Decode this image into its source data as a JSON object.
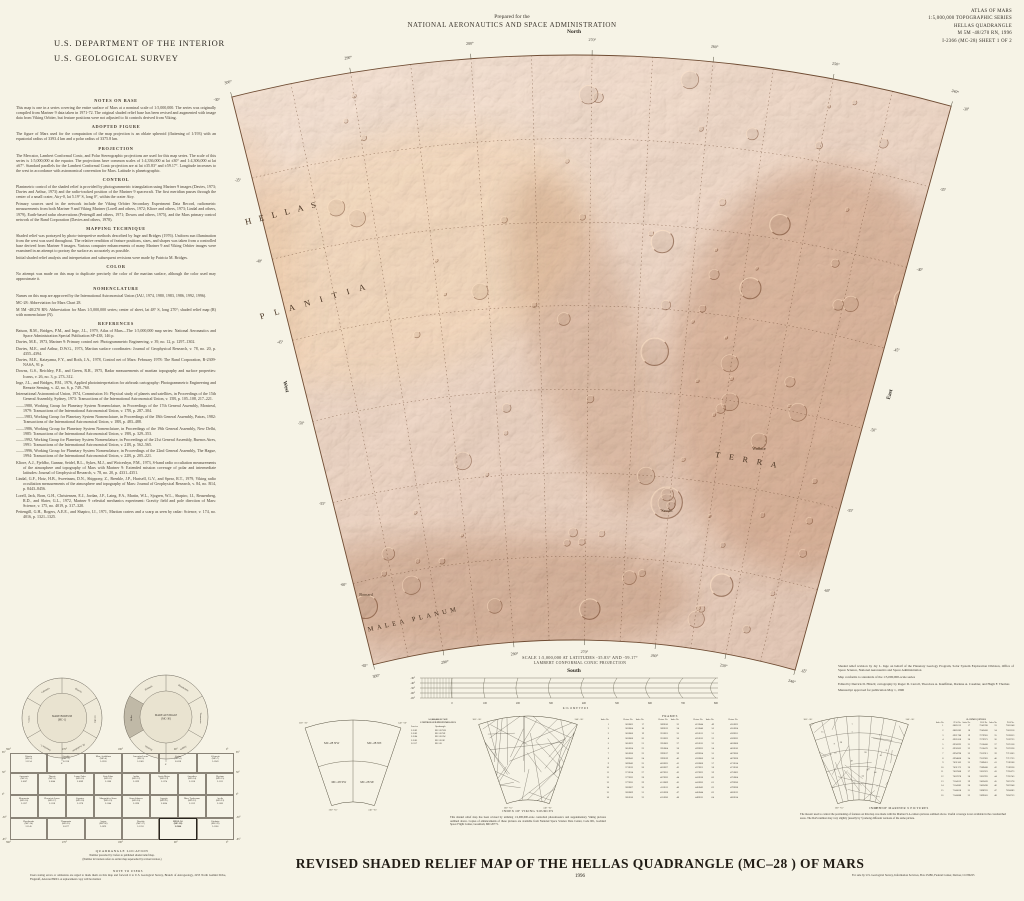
{
  "header": {
    "dept_line1": "U.S. DEPARTMENT OF THE INTERIOR",
    "dept_line2": "U.S. GEOLOGICAL SURVEY",
    "prepared_for": "Prepared for the",
    "nasa": "NATIONAL AERONAUTICS AND SPACE ADMINISTRATION",
    "atlas_lines": [
      "ATLAS OF MARS",
      "1:5,000,000 TOPOGRAPHIC SERIES",
      "HELLAS QUADRANGLE",
      "M 5M -48/270 RN, 1996",
      "I-2366 (MC-28) SHEET 1 OF 2"
    ]
  },
  "notes": {
    "sections": [
      {
        "heading": "NOTES ON BASE",
        "paragraphs": [
          "This map is one in a series covering the entire surface of Mars at a nominal scale of 1:5,000,000.  The series was originally compiled from Mariner 9 data taken in 1971-72.  The original shaded relief base has been revised and augmented with image data from Viking Orbiter, but feature positions were not adjusted to fit controls derived from Viking."
        ]
      },
      {
        "heading": "ADOPTED FIGURE",
        "paragraphs": [
          "The figure of Mars used for the computation of the map projection is an oblate spheroid (flattening of 1/193) with an equatorial radius of 3393.4 km and a polar radius of 3375.8 km."
        ]
      },
      {
        "heading": "PROJECTION",
        "paragraphs": [
          "The Mercator, Lambert Conformal Conic, and Polar Stereographic projections are used for this map series.  The scale of this series is 1:5,000,000 at the equator.  The projections have common scales of 1:4,336,000 at lat ±30° and 1:4,306,000 at lat ±67°.  Standard parallels for the Lambert Conformal Conic projection are at lat ±35.83° and ±59.17°.  Longitude increases to the west in accordance with astronomical convention for Mars.  Latitude is planetographic."
        ]
      },
      {
        "heading": "CONTROL",
        "paragraphs": [
          "Planimetric control of the shaded relief is provided by photogrammetric triangulation using Mariner 9 images (Davies, 1973; Davies and Arthur, 1973) and the radio-tracked position of the Mariner 9 spacecraft.  The first meridian passes through the center of a small crater, Airy-0, lat 5.19° S, long 0°, within the crater Airy.",
          "Primary sources used in the network include the Viking Orbiter Secondary Experiment Data Record, radiometric measurements from both Mariner 9 and Viking Mariner (Lorell and others, 1972; Kliore and others, 1973; Lindal and others, 1979), Earth-based radar observations (Pettengill and others, 1971; Downs and others, 1975), and the Mars primary control network of the Rand Corporation (Davies and others, 1978)."
        ]
      },
      {
        "heading": "MAPPING TECHNIQUE",
        "paragraphs": [
          "Shaded relief was portrayed by photo-interpretive methods described by Inge and Bridges (1976).  Uniform sun illumination from the west was used throughout.  The relative rendition of feature positions, sizes, and shapes was taken from a controlled base derived from Mariner 9 images.  Various computer enhancements of many Mariner 9 and Viking Orbiter images were examined in an attempt to portray the surface as accurately as possible.",
          "Initial shaded relief analysis and interpretation and subsequent revisions were made by Patricia M. Bridges."
        ]
      },
      {
        "heading": "COLOR",
        "paragraphs": [
          "No attempt was made on this map to duplicate precisely the color of the martian surface, although the color used may approximate it."
        ]
      },
      {
        "heading": "NOMENCLATURE",
        "paragraphs": [
          "Names on this map are approved by the International Astronomical Union (IAU, 1974, 1980, 1983, 1986, 1992, 1996).",
          "MC-28:  Abbreviation for Mars Chart 28.",
          "M 5M -48/270 RN:  Abbreviation for Mars 1:5,000,000 series; center of sheet, lat 48° S, long 270°; shaded relief map (R) with nomenclature (N)."
        ]
      }
    ],
    "references_heading": "REFERENCES",
    "references": [
      "Batson, R.M., Bridges, P.M., and Inge, J.L., 1979, Atlas of Mars—The 1:5,000,000 map series: National Aeronautics and Space Administration Special Publication SP-438, 146 p.",
      "Davies, M.E., 1973, Mariner 9: Primary control net: Photogrammetric Engineering, v. 39, no. 12, p. 1297–1302.",
      "Davies, M.E., and Arthur, D.W.G., 1973, Martian surface coordinates: Journal of Geophysical Research, v. 78, no. 20, p. 4355–4394.",
      "Davies, M.E., Katayama, F.Y., and Roth, J.A., 1978, Control net of Mars: February 1978: The Rand Corporation, R-2309-NASA, 91 p.",
      "Downs, G.S., Reichley, P.E., and Green, R.R., 1975, Radar measurements of martian topography and surface properties: Icarus, v. 26, no. 3, p. 273–312.",
      "Inge, J.L., and Bridges, P.M., 1976, Applied photointerpretation for airbrush cartography: Photogrammetric Engineering and Remote Sensing, v. 42, no. 6, p. 749–760.",
      "International Astronomical Union, 1974, Commission 16: Physical study of planets and satellites, in Proceedings of the 15th General Assembly, Sydney, 1973: Transactions of the International Astronomical Union, v. 15B, p. 105–108, 217–221.",
      "——1980, Working Group for Planetary System Nomenclature, in Proceedings of the 17th General Assembly, Montreal, 1979: Transactions of the International Astronomical Union, v. 17B, p. 287–304.",
      "——1983, Working Group for Planetary System Nomenclature, in Proceedings of the 18th General Assembly, Patras, 1982: Transactions of the International Astronomical Union, v. 18B, p. 483–488.",
      "——1986, Working Group for Planetary System Nomenclature, in Proceedings of the 19th General Assembly, New Delhi, 1985: Transactions of the International Astronomical Union, v. 19B, p. 329–353.",
      "——1992, Working Group for Planetary System Nomenclature, in Proceedings of the 21st General Assembly, Buenos Aires, 1991: Transactions of the International Astronomical Union, v. 21B, p. 562–565.",
      "——1996, Working Group for Planetary System Nomenclature, in Proceedings of the 22nd General Assembly, The Hague, 1994: Transactions of the International Astronomical Union, v. 22B, p. 205–221.",
      "Kliore, A.J., Fjeldbo, Gunnar, Seidel, B.L., Sykes, M.J., and Woiceshyn, P.M., 1973, S-band radio occultation measurements of the atmosphere and topography of Mars with Mariner 9: Extended mission coverage of polar and intermediate latitudes: Journal of Geophysical Research, v. 78, no. 20, p. 4331–4351.",
      "Lindal, G.F., Hotz, H.B., Sweetnam, D.N., Shippony, Z., Brenkle, J.P., Hartsell, G.V., and Spear, R.T., 1979, Viking radio occultation measurements of the atmosphere and topography of Mars: Journal of Geophysical Research, v. 84, no. B14, p. 8443–8456.",
      "Lorell, Jack, Born, G.H., Christensen, E.J., Jordan, J.F., Laing, P.A., Martin, W.L., Sjogren, W.L., Shapiro, I.I., Reasenberg, R.D., and Slater, G.L., 1972, Mariner 9 celestial mechanics experiment: Gravity field and pole direction of Mars: Science, v. 175, no. 4019, p. 317–320.",
      "Pettengill, G.H., Rogers, A.E.E., and Shapiro, I.I., 1971, Martian craters and a scarp as seen by radar: Science, v. 174, no. 4016, p. 1321–1325."
    ]
  },
  "map": {
    "compass": {
      "north": "North",
      "south": "South",
      "east": "East",
      "west": "West"
    },
    "lon_labels": [
      "300°",
      "290°",
      "280°",
      "270°",
      "260°",
      "250°",
      "240°"
    ],
    "lat_labels": [
      "-65°",
      "-60°",
      "-55°",
      "-50°",
      "-45°",
      "-40°",
      "-35°",
      "-30°"
    ],
    "region_labels": [
      {
        "t": "HELLAS",
        "x": 285,
        "y": 215,
        "r": -14,
        "ls": 8,
        "s": 8.5
      },
      {
        "t": "PLANITIA",
        "x": 318,
        "y": 303,
        "r": -16,
        "ls": 10,
        "s": 8.5
      },
      {
        "t": "MALEA  PLANUM",
        "x": 414,
        "y": 621,
        "r": -13,
        "ls": 3.5,
        "s": 6.5
      },
      {
        "t": "TERRA",
        "x": 750,
        "y": 463,
        "r": 10,
        "ls": 9,
        "s": 8
      }
    ],
    "crater_labels": [
      {
        "t": "Wallace",
        "x": 759,
        "y": 450,
        "s": 4.2
      },
      {
        "t": "Secchi",
        "x": 667,
        "y": 512,
        "s": 4.2
      },
      {
        "t": "Barnard",
        "x": 366,
        "y": 596,
        "s": 4.2
      }
    ],
    "colors": {
      "base_light": "#edc09c",
      "base_mid": "#dda57c",
      "base_dark": "#c47f52",
      "line": "#6f4c33"
    }
  },
  "scalebar": {
    "title1": "SCALE 1:5,000,000 AT LATITUDES -35.83° AND -59.17°",
    "title2": "LAMBERT CONFORMAL CONIC PROJECTION",
    "lat_labels": [
      "-30°",
      "-40°",
      "-50°",
      "-60°",
      "-65°"
    ],
    "km_labels": [
      "0",
      "100",
      "200",
      "300",
      "400",
      "500",
      "600",
      "700",
      "800"
    ],
    "unit": "KILOMETERS"
  },
  "credits": {
    "paragraphs": [
      "Shaded relief revision by Jay L. Inge on behalf of the Planetary Geology Program, Solar System Exploration Division, Office of Space Science, National Aeronautics and Space Administration",
      "Map conforms to standards of the 1:5,000,000-scale series",
      "Edited by Derrick D. Hirsch; cartography by Roger D. Carroll, Theodore A. Kauffman, Darlene A. Casebier, and Hugh F. Thomas",
      "Manuscript approved for publication May 1, 1996"
    ]
  },
  "hemispheres": {
    "left": {
      "center_lines": [
        "MARE BOREUM",
        "(MC-1)"
      ],
      "segments": [
        "Diacria",
        "Arcadia",
        "M. Acidalium",
        "Ismenius L.",
        "Casius",
        "Cebrenia"
      ],
      "tick": "0°"
    },
    "right": {
      "center_lines": [
        "MARE AUSTRALE",
        "(MC-30)"
      ],
      "segments": [
        "Phaethontis",
        "Thaumasia",
        "Argyre",
        "Noachis",
        "Hellas",
        "Eridania"
      ],
      "shaded_index": 4,
      "tick": "0°"
    }
  },
  "quad_index": {
    "rows": [
      [
        {
          "n": "Diacria",
          "mc": "(MC-2)",
          "i": "I-1154"
        },
        {
          "n": "Arcadia",
          "mc": "(MC-3)",
          "i": "I-1218"
        },
        {
          "n": "Mare Acidalium",
          "mc": "(MC-4)",
          "i": "I-1228"
        },
        {
          "n": "Ismenius Lacus",
          "mc": "(MC-5)",
          "i": "I-1065"
        },
        {
          "n": "Casius",
          "mc": "(MC-6)",
          "i": "I-1038"
        },
        {
          "n": "Cebrenia",
          "mc": "(MC-7)",
          "i": "I-1249"
        }
      ],
      [
        {
          "n": "Amazonis",
          "mc": "(MC-8)",
          "i": "I-1087"
        },
        {
          "n": "Tharsis",
          "mc": "(MC-9)",
          "i": "I-1044"
        },
        {
          "n": "Lunae Palus",
          "mc": "(MC-10)",
          "i": "I-1089"
        },
        {
          "n": "Oxia Palus",
          "mc": "(MC-11)",
          "i": "I-1186"
        },
        {
          "n": "Arabia",
          "mc": "(MC-12)",
          "i": "I-1199"
        },
        {
          "n": "Syrtis Major",
          "mc": "(MC-13)",
          "i": "I-1174"
        },
        {
          "n": "Amenthes",
          "mc": "(MC-14)",
          "i": "I-1116"
        },
        {
          "n": "Elysium",
          "mc": "(MC-15)",
          "i": "I-1111"
        }
      ],
      [
        {
          "n": "Memnonia",
          "mc": "(MC-16)",
          "i": "I-1137"
        },
        {
          "n": "Phoenicis Lacus",
          "mc": "(MC-17)",
          "i": "I-1118"
        },
        {
          "n": "Coprates",
          "mc": "(MC-18)",
          "i": "I-1178"
        },
        {
          "n": "Margaritifer Sinus",
          "mc": "(MC-19)",
          "i": "I-1144"
        },
        {
          "n": "Sinus Sabaeus",
          "mc": "(MC-20)",
          "i": "I-1196"
        },
        {
          "n": "Iapygia",
          "mc": "(MC-21)",
          "i": "I-1064"
        },
        {
          "n": "Mare Tyrrhenum",
          "mc": "(MC-22)",
          "i": "I-1112"
        },
        {
          "n": "Aeolis",
          "mc": "(MC-23)",
          "i": "I-1165"
        }
      ],
      [
        {
          "n": "Phaethontis",
          "mc": "(MC-24)",
          "i": "I-1145"
        },
        {
          "n": "Thaumasia",
          "mc": "(MC-25)",
          "i": "I-1077"
        },
        {
          "n": "Argyre",
          "mc": "(MC-26)",
          "i": "I-1091"
        },
        {
          "n": "Noachis",
          "mc": "(MC-27)",
          "i": "I-1210"
        },
        {
          "n": "HELLAS",
          "mc": "(MC-28)",
          "i": "I-2366",
          "hl": true
        },
        {
          "n": "Eridania",
          "mc": "(MC-29)",
          "i": "I-1106"
        }
      ]
    ],
    "lat_labels": [
      "65°",
      "30°",
      "0°",
      "-30°",
      "-65°"
    ],
    "lon_labels": [
      "360°",
      "270°",
      "180°",
      "90°",
      "0°"
    ],
    "caption1": "QUADRANGLE LOCATION",
    "caption2": "Number preceded by I refers to published shaded relief map.",
    "caption3": "(Number in brackets refers to earlier map superseded by revised version.)"
  },
  "note_to_users": {
    "heading": "NOTE TO USERS",
    "body": "Users noting errors or omissions are urged to mark them on this map and forward it to U.S. Geological Survey, Branch of Astrogeology, 2255 North Gemini Drive, Flagstaff, Arizona 86001.  A replacement copy will be mailed."
  },
  "subdivision": {
    "cells": [
      "MC-28 NW",
      "MC-28 NE",
      "MC-28 SW",
      "MC-28 SE"
    ],
    "corners": {
      "tl": "300° -30°",
      "tr": "240° -30°",
      "bl": "300° -65°",
      "br": "240° -65°"
    },
    "table_h1": "1:2,000,000 SCALE",
    "table_h2": "CONTROLLED PHOTOMOSAICS",
    "table_cols": [
      "I-series",
      "Quadrangle"
    ],
    "table_rows": [
      [
        "I-1582",
        "MC-28 NW"
      ],
      [
        "I-1583",
        "MC-28 NE"
      ],
      [
        "I-1584",
        "MC-28 SW"
      ],
      [
        "I-1585",
        "MC-28 SE"
      ],
      [
        "I-2117",
        "MC-28"
      ]
    ]
  },
  "viking": {
    "caption": "INDEX OF VIKING SOURCES",
    "paragraph": "This shaded relief map has been revised by utilizing 1:2,000,000-scale controlled photomosaics and supplementary Viking pictures outlined above.  Copies of enhancements of these pictures are available from National Space Science Data Center, Code 601, Goddard Space Flight Center, Greenbelt, MD  20771."
  },
  "frames_table": {
    "title": "FRAMES",
    "col_headers": [
      "Index No.",
      "Picture No."
    ],
    "rows": [
      [
        "1",
        "363B02",
        "17",
        "389B10",
        "33",
        "421B44",
        "49",
        "455B22"
      ],
      [
        "2",
        "363B04",
        "18",
        "389B12",
        "34",
        "421B46",
        "50",
        "455B24"
      ],
      [
        "3",
        "363B06",
        "19",
        "391B21",
        "35",
        "425B11",
        "51",
        "459B31"
      ],
      [
        "4",
        "363B08",
        "20",
        "391B23",
        "36",
        "425B13",
        "52",
        "459B33"
      ],
      [
        "5",
        "365B22",
        "21",
        "395B02",
        "37",
        "425B15",
        "53",
        "463B08"
      ],
      [
        "6",
        "365B24",
        "22",
        "395B04",
        "38",
        "429B32",
        "54",
        "463B10"
      ],
      [
        "7",
        "365B26",
        "23",
        "399B17",
        "39",
        "429B34",
        "55",
        "467B26"
      ],
      [
        "8",
        "369B41",
        "24",
        "399B19",
        "40",
        "433B06",
        "56",
        "467B28"
      ],
      [
        "9",
        "369B43",
        "25",
        "403B25",
        "41",
        "433B08",
        "57",
        "471B14"
      ],
      [
        "10",
        "371B12",
        "26",
        "403B27",
        "42",
        "437B21",
        "58",
        "471B16"
      ],
      [
        "11",
        "371B14",
        "27",
        "407B31",
        "43",
        "437B23",
        "59",
        "475B02"
      ],
      [
        "12",
        "377B33",
        "28",
        "407B33",
        "44",
        "441B18",
        "60",
        "475B04"
      ],
      [
        "13",
        "377B35",
        "29",
        "411B09",
        "45",
        "441B20",
        "61",
        "479B36"
      ],
      [
        "14",
        "383B07",
        "30",
        "411B11",
        "46",
        "445B42",
        "62",
        "479B38"
      ],
      [
        "15",
        "383B09",
        "31",
        "415B28",
        "47",
        "445B44",
        "63",
        "483B12"
      ],
      [
        "16",
        "385B16",
        "32",
        "415B30",
        "48",
        "449B15",
        "64",
        "483B14"
      ]
    ]
  },
  "mariner": {
    "table_title": "A-camera pictures",
    "col_headers": [
      "Index No.",
      "DAS No."
    ],
    "rows": [
      [
        "1",
        "6885213",
        "17",
        "7243398",
        "33",
        "7603148"
      ],
      [
        "2",
        "6885283",
        "18",
        "7243468",
        "34",
        "7603218"
      ],
      [
        "3",
        "6921788",
        "19",
        "7279903",
        "35",
        "7639653"
      ],
      [
        "4",
        "6921858",
        "20",
        "7279973",
        "36",
        "7639723"
      ],
      [
        "5",
        "6958293",
        "21",
        "7316408",
        "37",
        "7676158"
      ],
      [
        "6",
        "6958363",
        "22",
        "7316478",
        "38",
        "7676228"
      ],
      [
        "7",
        "6994798",
        "23",
        "7352913",
        "39",
        "7712663"
      ],
      [
        "8",
        "6994868",
        "24",
        "7352983",
        "40",
        "7712733"
      ],
      [
        "9",
        "7031303",
        "25",
        "7389418",
        "41",
        "7749168"
      ],
      [
        "10",
        "7031373",
        "26",
        "7389488",
        "42",
        "7749238"
      ],
      [
        "11",
        "7067808",
        "27",
        "7425923",
        "43",
        "7785673"
      ],
      [
        "12",
        "7067878",
        "28",
        "7425993",
        "44",
        "7785743"
      ],
      [
        "13",
        "7104313",
        "29",
        "7462428",
        "45",
        "7822178"
      ],
      [
        "14",
        "7104383",
        "30",
        "7462498",
        "46",
        "7822248"
      ],
      [
        "15",
        "7140818",
        "31",
        "7498933",
        "47",
        "7858683"
      ],
      [
        "16",
        "7140888",
        "32",
        "7499003",
        "48",
        "7858753"
      ]
    ],
    "caption": "INDEX OF MARINER 9 PICTURES",
    "paragraph": "The mosaic used to control the positioning of features on this map was made with the Mariner 9 A-camera pictures outlined above.  Useful coverage is not available in the crosshatched areas.  The DAS number may vary slightly (usually by 5) among different versions of the same picture."
  },
  "title_block": {
    "title": "REVISED SHADED RELIEF MAP OF THE HELLAS QUADRANGLE (MC–28 ) OF MARS",
    "year": "1996"
  },
  "fine_print": {
    "sale": "For sale by U.S. Geological Survey, Information Services, Box 25286, Federal Center, Denver, CO 80225"
  }
}
